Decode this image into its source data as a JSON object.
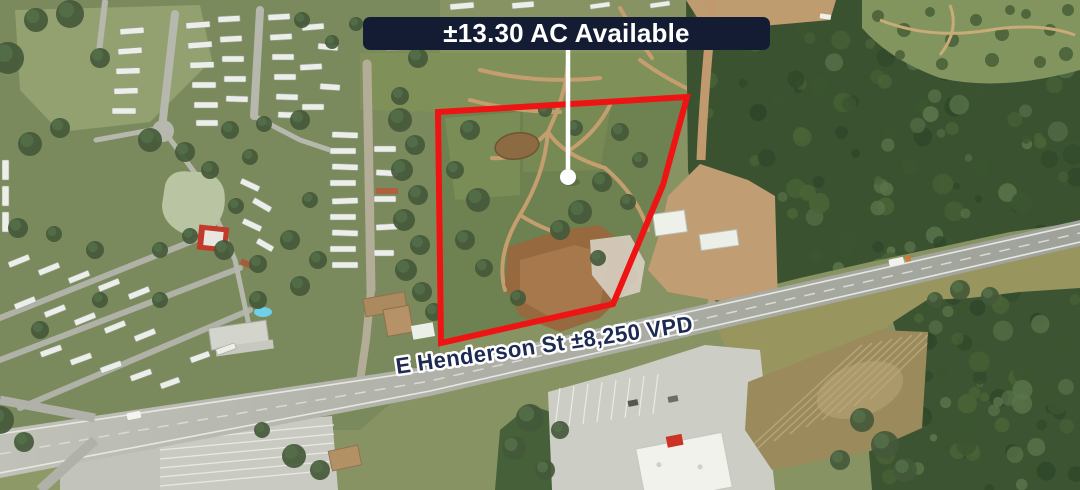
{
  "annotations": {
    "acreage_label": "±13.30 AC Available",
    "street_label": "E Henderson St ±8,250 VPD"
  },
  "marker": {
    "type": "pin-line-with-dot",
    "color": "#ffffff"
  },
  "colors": {
    "boundary_red": "#ee1414",
    "label_bg": "#131c33",
    "label_text": "#ffffff",
    "street_label_fill": "#1d2b52",
    "street_label_stroke": "#ffffff",
    "pin_white": "#ffffff"
  }
}
